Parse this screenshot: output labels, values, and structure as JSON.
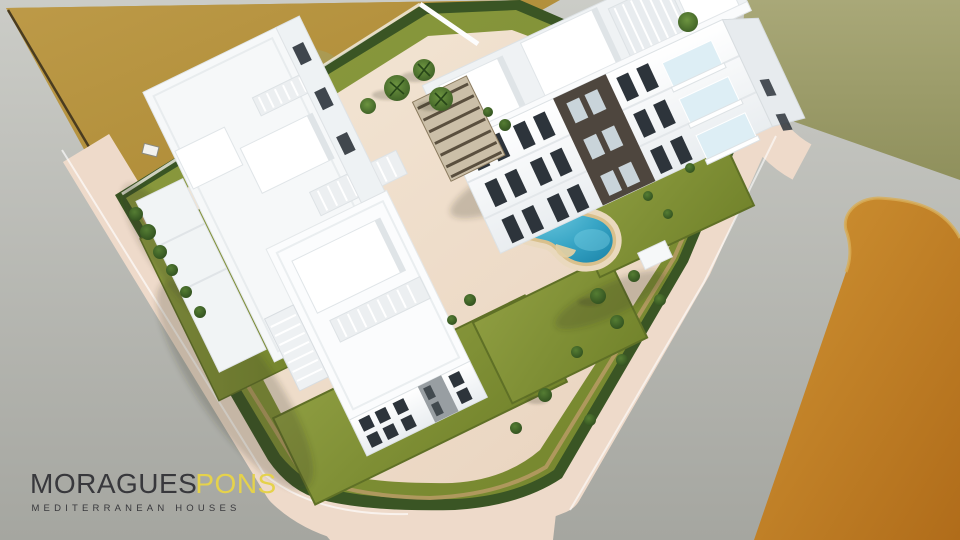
{
  "logo": {
    "brand_primary": "MORAGUES",
    "brand_secondary": "PONS",
    "tagline": "MEDITERRANEAN HOUSES"
  },
  "scene": {
    "type": "aerial-architectural-render",
    "subject": "white Mediterranean apartment complex with curved swimming pool, lawns and perimeter roads",
    "elements": [
      "dirt field",
      "green meadow",
      "orange scrubland",
      "perimeter road",
      "pink sidewalk",
      "boundary hedge",
      "garden wall",
      "lawns",
      "pool deck",
      "swimming pool",
      "sun loungers",
      "benches",
      "front apartment block",
      "rear apartment block",
      "roof pergolas",
      "external staircase",
      "palm trees",
      "shrubs"
    ]
  },
  "colors": {
    "road": "#b0b1ab",
    "sidewalk": "#eedaca",
    "dirt_field": "#b5913d",
    "grass_field": "#9d9d6c",
    "scrub_field": "#c07d24",
    "lawn": "#81913a",
    "hedge": "#3a5524",
    "garden_wall": "#b59a63",
    "building_white": "#f7f9fa",
    "facade_shadow": "#e9edf0",
    "accent_wall_dark": "#4e463e",
    "window": "#2d343b",
    "pool_water": "#2f9cbe",
    "pool_deck_rim": "#d9c08c",
    "pergola_wood": "#5a4f3e",
    "logo_dark": "#38383c",
    "logo_yellow": "#e5d24b"
  }
}
